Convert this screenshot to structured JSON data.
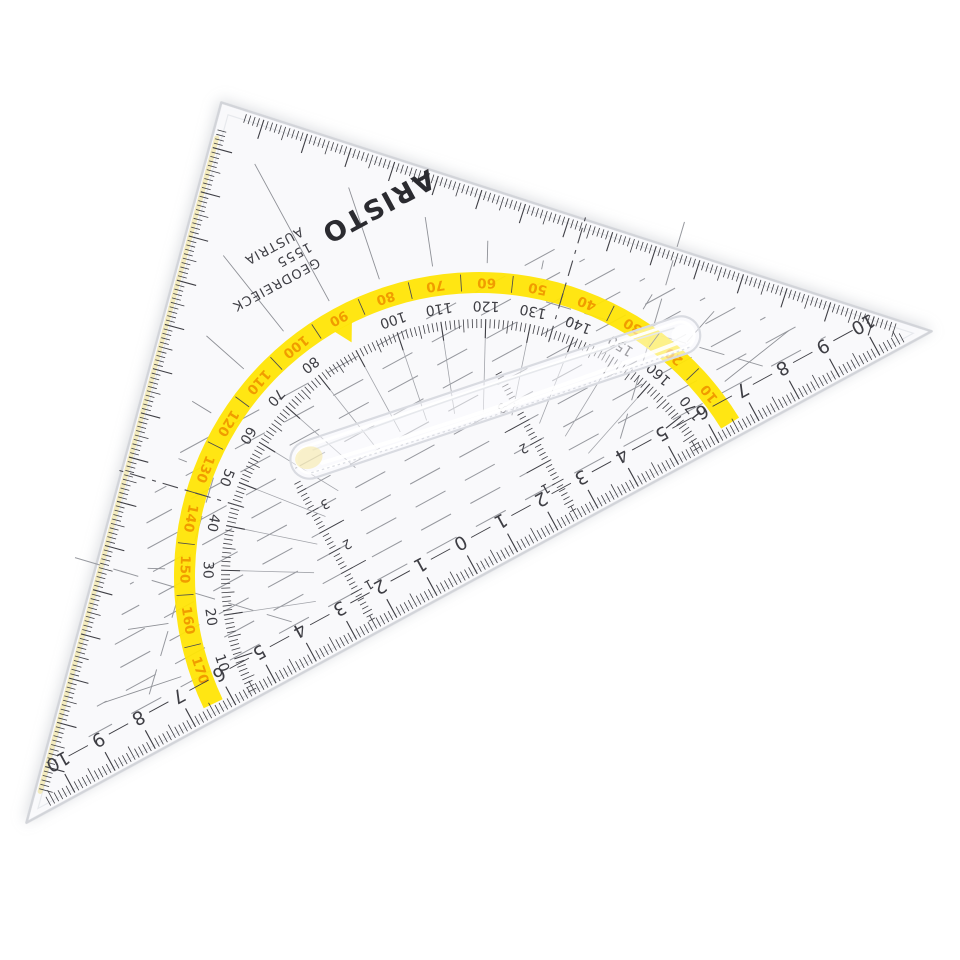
{
  "scene": {
    "description": "Photograph of a transparent ARISTO Geodreieck protractor set square on white, rotated about 151 degrees",
    "background": "#ffffff"
  },
  "instrument": {
    "brand": {
      "logo": "ARISTO",
      "product": "GEODREIECK",
      "model": "1555",
      "country": "AUSTRIA"
    },
    "colors": {
      "body": "#FBFBFD",
      "edge": "#D2D4D9",
      "bevel": "#E7E9ED",
      "edge_tint": "#EFE08E",
      "ink": "#3E3E44",
      "faint": "#8E9096",
      "guide": "#97999F",
      "inner_ray": "#A2A4AA",
      "highlight_band": "#FFE506",
      "band_numerals": "#F09C00",
      "dash_dot": "#4A4A50",
      "handle_edge": "#D9DBE1"
    },
    "protractor": {
      "degrees_outer_yellow": [
        10,
        20,
        30,
        40,
        50,
        60,
        70,
        80,
        90,
        100,
        110,
        120,
        130,
        140,
        150,
        160,
        170
      ],
      "degrees_inner_black": [
        10,
        20,
        30,
        40,
        50,
        60,
        70,
        80,
        100,
        110,
        120,
        130,
        140,
        150,
        160,
        170
      ],
      "tick_step_deg": 1,
      "medium_tick_step_deg": 5,
      "label_step_deg": 10,
      "notch_deg": 90
    },
    "hypotenuse_scale": {
      "unit": "cm",
      "zero_at_center": true,
      "labels_each_side": [
        0,
        1,
        2,
        3,
        4,
        5,
        6,
        7,
        8,
        9,
        10
      ],
      "tick_step_mm": 1
    },
    "perpendicular_scales": {
      "labels": [
        1,
        2,
        3
      ],
      "tick_step_mm": 1
    },
    "parallel_guides": {
      "spacing_mm": 5,
      "row_count": 10
    }
  }
}
